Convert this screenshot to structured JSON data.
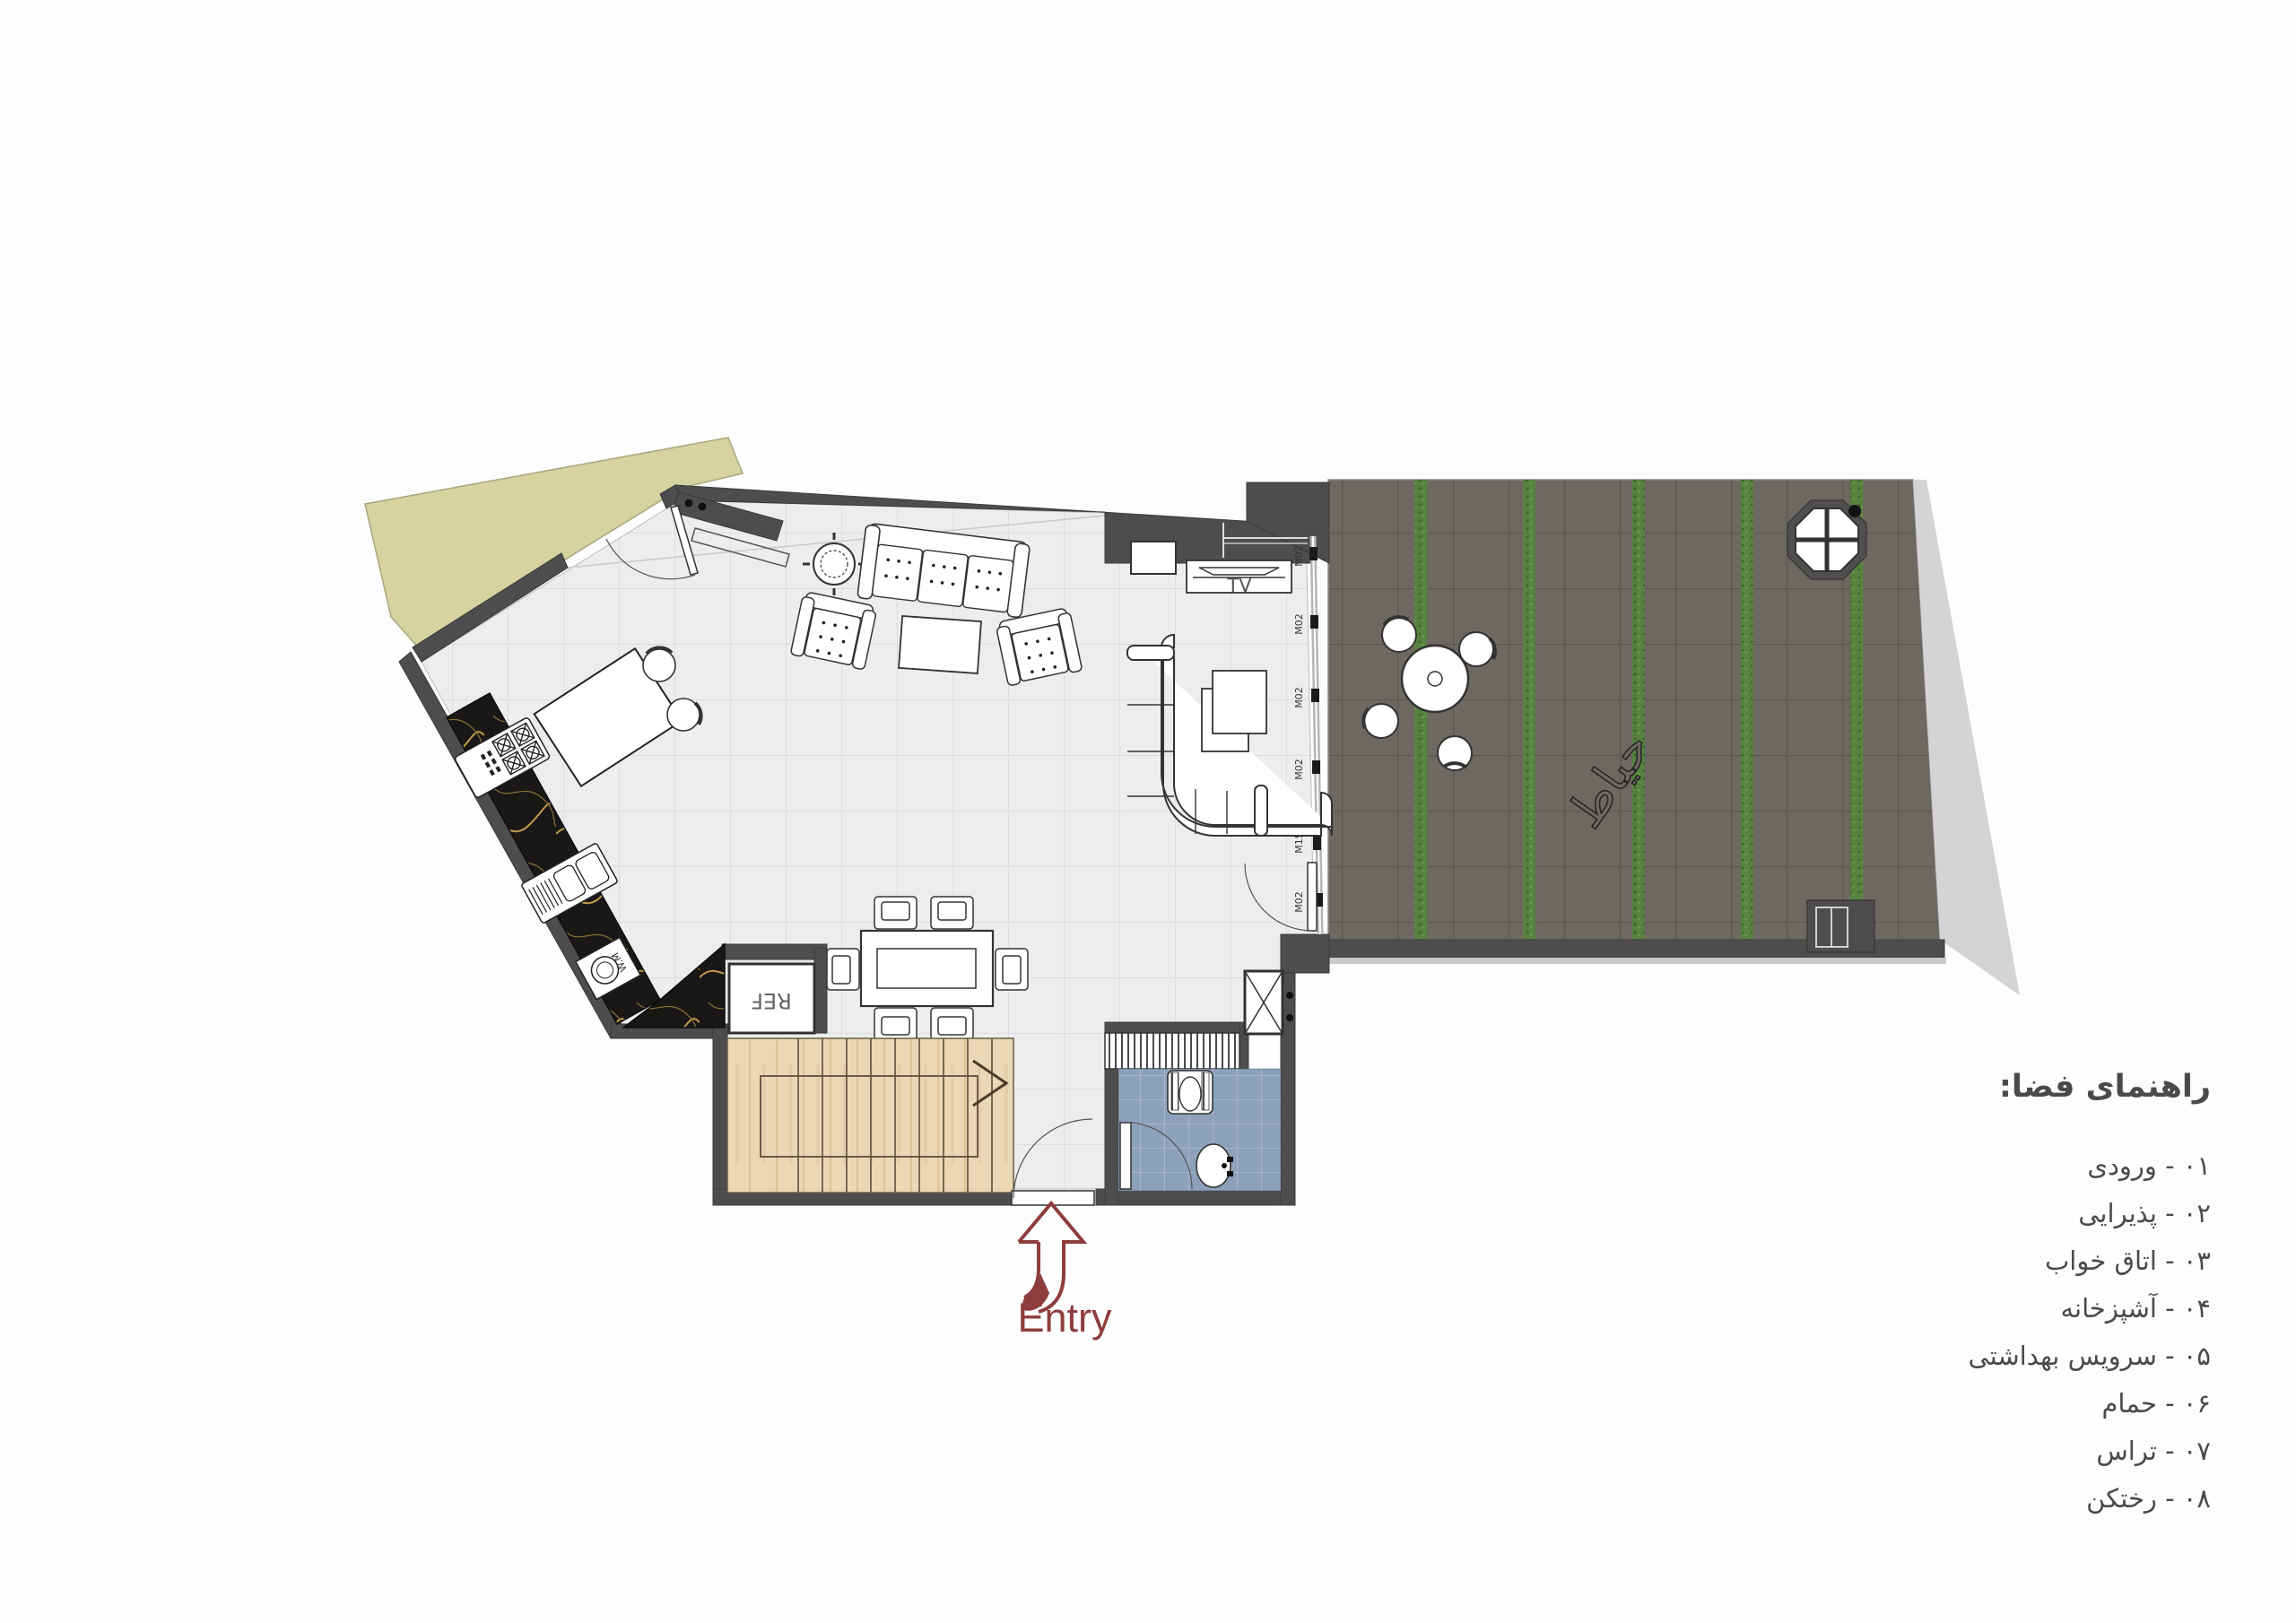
{
  "legend": {
    "title": "راهنمای فضا:",
    "items": [
      "۰۱ -  ورودی",
      "۰۲ -  پذیرایی",
      "۰۳ - اتاق خواب",
      "۰۴ - آشپزخانه",
      "۰۵ - سرویس بهداشتی",
      "۰۶ -  حمام",
      "۰۷ -  تراس",
      "۰۸ - رختکن"
    ]
  },
  "entry": {
    "label": "Entry"
  },
  "plan": {
    "tv_label": "TV",
    "ref_label": "REF",
    "wm_label": "W.M",
    "yard_label": "حیاط",
    "window_label": "M02",
    "door_label": "M15"
  },
  "colors": {
    "accent_maroon": "#8e3d3d",
    "wall_gray": "#4d4d4d",
    "olive_yard": "#d6d3a0",
    "courtyard_paving": "#6e6862",
    "planting_green": "#57823f",
    "wood_stairs": "#ead7b6",
    "bath_tile_blue": "#8da1bb",
    "marble_black": "#1a1816"
  }
}
